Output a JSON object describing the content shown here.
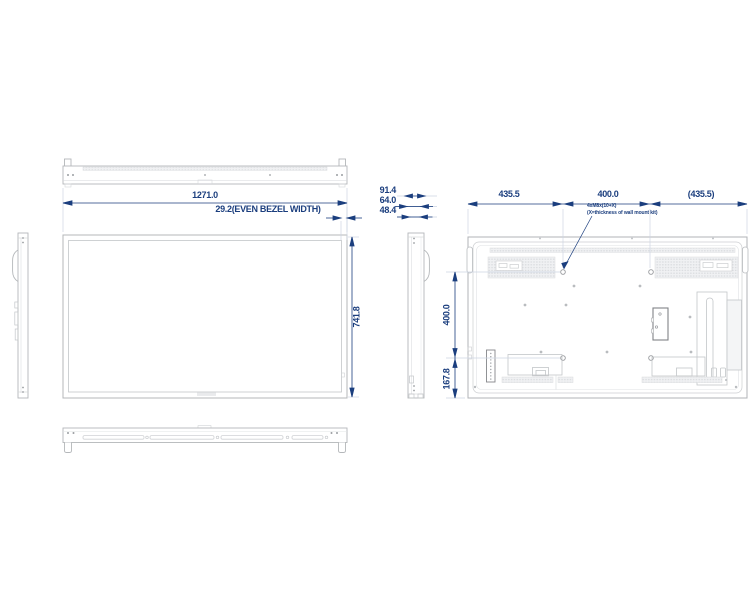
{
  "dims": {
    "front_width": "1271.0",
    "bezel_width": "29.2(EVEN BEZEL WIDTH)",
    "depth_overall": "91.4",
    "depth_handle": "64.0",
    "depth_body": "48.4",
    "front_height": "741.8",
    "rear_span_left": "435.5",
    "rear_span_center": "400.0",
    "rear_span_right": "(435.5)",
    "vesa_vertical": "400.0",
    "bottom_offset": "167.8"
  },
  "note": {
    "line1": "4xM8x(10+X)",
    "line2": "(X=thickness of wall mount kit)"
  },
  "colors": {
    "dimension": "#1b3e7e",
    "outline": "#b4b7ba",
    "outline_light": "#d0d2d5",
    "extension": "#cdd5e3",
    "background": "#ffffff"
  }
}
